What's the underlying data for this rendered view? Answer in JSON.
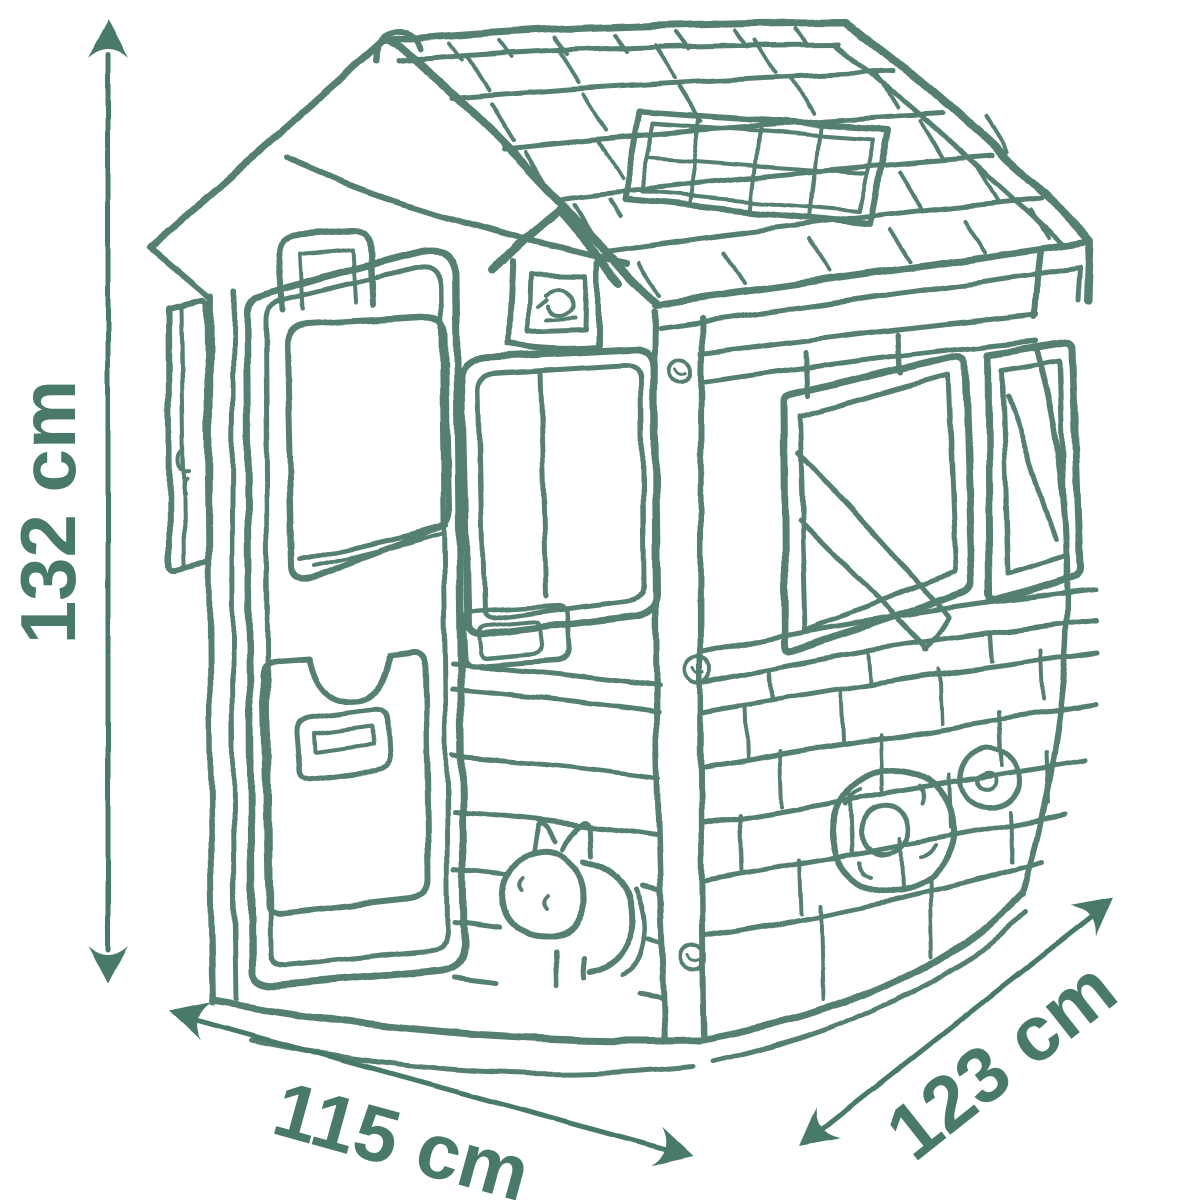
{
  "page": {
    "background_color": "#ffffff",
    "description": "Dimension diagram of a children's playhouse, hand-drawn sketch style"
  },
  "sketch": {
    "subject": "playhouse",
    "stroke_color": "#55806F",
    "features": "tiled roof with skylight panel, birdhouse, front door with window, front window, side window with open shutter, brick lower wall with flower wreath, cat sitting by the door"
  },
  "dimensions": {
    "color": "#48796A",
    "height": {
      "label": "132 cm"
    },
    "width": {
      "label": "115 cm"
    },
    "depth": {
      "label": "123 cm"
    }
  }
}
